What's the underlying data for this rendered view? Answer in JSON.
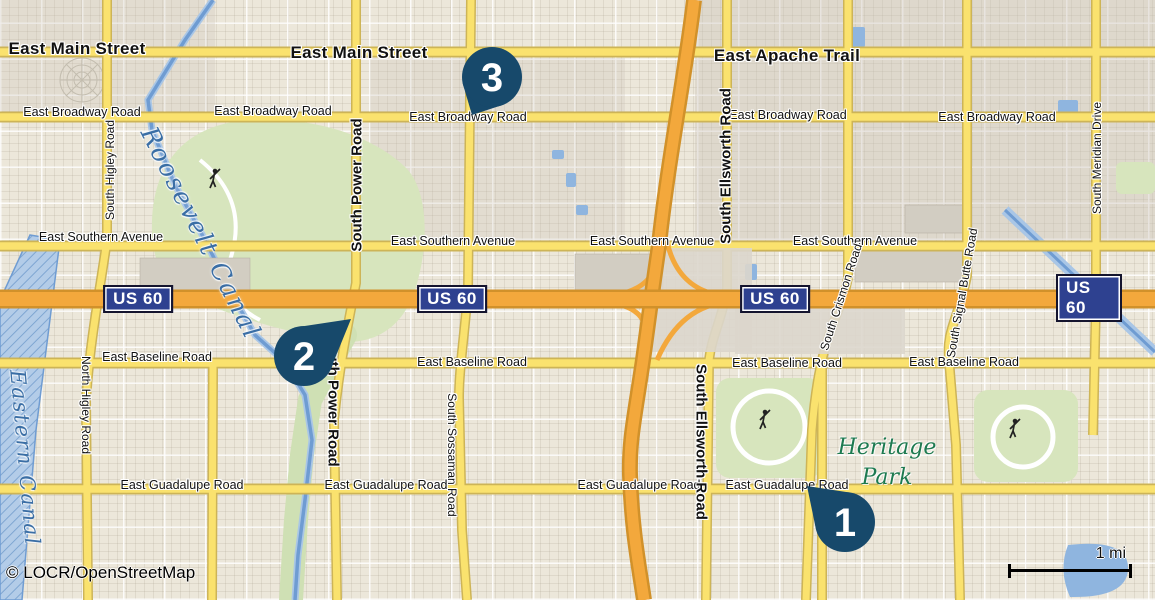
{
  "map": {
    "attribution": {
      "text": "© LOCR/OpenStreetMap"
    },
    "scale_bar": {
      "label": "1 mi"
    },
    "colors": {
      "pin": "#17496b",
      "shield_bg": "#2e4190",
      "road_yellow": "#fae26e",
      "highway_orange": "#f3a83c",
      "water": "#8fb5df",
      "park_green": "#d7e5bd",
      "water_label": "#3a6ea5",
      "park_label": "#1d7a50"
    },
    "shields": [
      {
        "label": "US 60",
        "x": 138,
        "y": 299
      },
      {
        "label": "US 60",
        "x": 452,
        "y": 299
      },
      {
        "label": "US 60",
        "x": 775,
        "y": 299
      },
      {
        "label": "US 60",
        "x": 1089,
        "y": 298
      }
    ],
    "markers": [
      {
        "n": "1",
        "cx": 845,
        "cy": 522,
        "tx": 807,
        "ty": 486
      },
      {
        "n": "2",
        "cx": 304,
        "cy": 356,
        "tx": 351,
        "ty": 319
      },
      {
        "n": "3",
        "cx": 492,
        "cy": 77,
        "tx": 472,
        "ty": 115
      }
    ],
    "road_labels": [
      {
        "t": "East Main Street",
        "x": 77,
        "y": 49,
        "r": 0,
        "c": "h1"
      },
      {
        "t": "East Main Street",
        "x": 359,
        "y": 53,
        "r": 0,
        "c": "h1"
      },
      {
        "t": "East Apache Trail",
        "x": 787,
        "y": 56,
        "r": 0,
        "c": "h1"
      },
      {
        "t": "East Broadway Road",
        "x": 82,
        "y": 112,
        "r": 0,
        "c": "h2"
      },
      {
        "t": "East Broadway Road",
        "x": 273,
        "y": 111,
        "r": 0,
        "c": "h2"
      },
      {
        "t": "East Broadway Road",
        "x": 468,
        "y": 117,
        "r": 0,
        "c": "h2"
      },
      {
        "t": "East Broadway Road",
        "x": 788,
        "y": 115,
        "r": 0,
        "c": "h2"
      },
      {
        "t": "East Broadway Road",
        "x": 997,
        "y": 117,
        "r": 0,
        "c": "h2"
      },
      {
        "t": "East Southern Avenue",
        "x": 101,
        "y": 237,
        "r": 0,
        "c": "h2"
      },
      {
        "t": "East Southern Avenue",
        "x": 453,
        "y": 241,
        "r": 0,
        "c": "h2"
      },
      {
        "t": "East Southern Avenue",
        "x": 652,
        "y": 241,
        "r": 0,
        "c": "h2"
      },
      {
        "t": "East Southern Avenue",
        "x": 855,
        "y": 241,
        "r": 0,
        "c": "h2"
      },
      {
        "t": "East Baseline Road",
        "x": 157,
        "y": 357,
        "r": 0,
        "c": "h2"
      },
      {
        "t": "East Baseline Road",
        "x": 472,
        "y": 362,
        "r": 0,
        "c": "h2"
      },
      {
        "t": "East Baseline Road",
        "x": 787,
        "y": 363,
        "r": 0,
        "c": "h2"
      },
      {
        "t": "East Baseline Road",
        "x": 964,
        "y": 362,
        "r": 0,
        "c": "h2"
      },
      {
        "t": "East Guadalupe Road",
        "x": 182,
        "y": 485,
        "r": 0,
        "c": "h2"
      },
      {
        "t": "East Guadalupe Road",
        "x": 386,
        "y": 485,
        "r": 0,
        "c": "h2"
      },
      {
        "t": "East Guadalupe Road",
        "x": 639,
        "y": 485,
        "r": 0,
        "c": "h2"
      },
      {
        "t": "East Guadalupe Road",
        "x": 787,
        "y": 485,
        "r": 0,
        "c": "h2"
      },
      {
        "t": "South Higley Road",
        "x": 110,
        "y": 170,
        "r": -90,
        "c": "v2"
      },
      {
        "t": "North Higley Road",
        "x": 86,
        "y": 405,
        "r": 90,
        "c": "v2"
      },
      {
        "t": "South Power Road",
        "x": 357,
        "y": 185,
        "r": -90,
        "c": "v1"
      },
      {
        "t": "South Power Road",
        "x": 333,
        "y": 400,
        "r": 90,
        "c": "v1"
      },
      {
        "t": "South Sossaman Road",
        "x": 452,
        "y": 455,
        "r": 90,
        "c": "v2"
      },
      {
        "t": "South Ellsworth Road",
        "x": 726,
        "y": 166,
        "r": -90,
        "c": "v1"
      },
      {
        "t": "South Ellsworth Road",
        "x": 701,
        "y": 442,
        "r": 90,
        "c": "v1"
      },
      {
        "t": "South Crismon Road",
        "x": 841,
        "y": 297,
        "r": -72,
        "c": "v2"
      },
      {
        "t": "South Signal Butte Road",
        "x": 962,
        "y": 293,
        "r": -80,
        "c": "v2"
      },
      {
        "t": "South Meridian Drive",
        "x": 1097,
        "y": 158,
        "r": -90,
        "c": "v2"
      }
    ],
    "place_labels": [
      {
        "t": "Roosevelt Canal",
        "x": 201,
        "y": 233,
        "r": 63,
        "c": "water-lg"
      },
      {
        "t": "Eastern Canal",
        "x": 25,
        "y": 458,
        "r": 85,
        "c": "water-md"
      },
      {
        "t": "Heritage Park",
        "x": 887,
        "y": 463,
        "r": 0,
        "c": "park"
      }
    ]
  }
}
